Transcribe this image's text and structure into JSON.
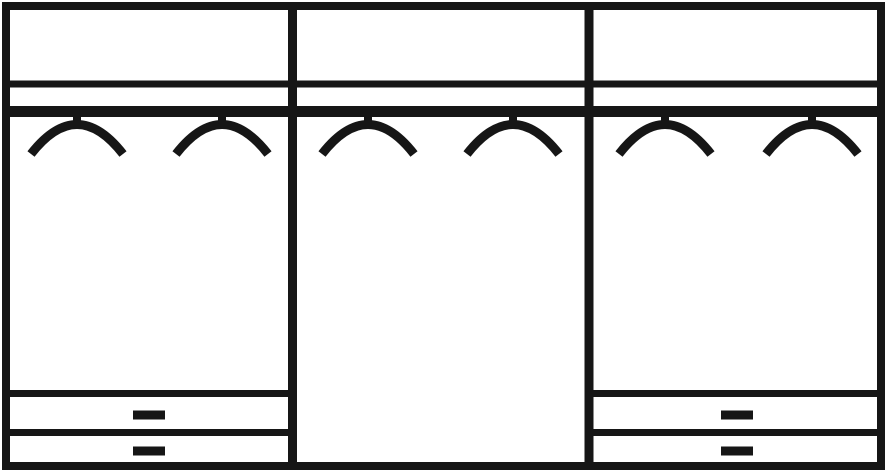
{
  "canvas": {
    "width": 887,
    "height": 472,
    "background": "#ffffff",
    "line_color": "#161616"
  },
  "diagram": {
    "kind": "wardrobe-front-schematic",
    "frame": {
      "x": 2,
      "y": 2,
      "width": 883,
      "height": 468,
      "stroke": 8
    },
    "dividers": {
      "stroke": 9,
      "positions_x": [
        292.5,
        589
      ]
    },
    "shelf_line": {
      "y": 84,
      "stroke": 7
    },
    "clothes_rail": {
      "y": 111.5,
      "stroke": 11
    },
    "hangers": {
      "stem_stroke": 8,
      "arc_stroke": 9,
      "stem_top_y": 108,
      "stem_bottom_y": 127,
      "arc_end_y": 154,
      "arc_ctrl_y": 95,
      "arc_half_width": 46,
      "positions_x": [
        77,
        222,
        368,
        513,
        665,
        812
      ]
    },
    "sections": [
      {
        "id": "left",
        "x_start": 6,
        "x_end": 292.5,
        "hanger_count": 2,
        "drawers": {
          "count": 2,
          "top_line_y": 393.5,
          "mid_line_y": 432.5,
          "line_stroke": 7,
          "handle": {
            "width": 32,
            "height": 9,
            "x_center": 149,
            "y_centers": [
              415,
              451
            ]
          }
        }
      },
      {
        "id": "middle",
        "x_start": 292.5,
        "x_end": 589,
        "hanger_count": 2,
        "drawers": null
      },
      {
        "id": "right",
        "x_start": 589,
        "x_end": 881,
        "hanger_count": 2,
        "drawers": {
          "count": 2,
          "top_line_y": 393.5,
          "mid_line_y": 432.5,
          "line_stroke": 7,
          "handle": {
            "width": 32,
            "height": 9,
            "x_center": 737,
            "y_centers": [
              415,
              451
            ]
          }
        }
      }
    ]
  }
}
